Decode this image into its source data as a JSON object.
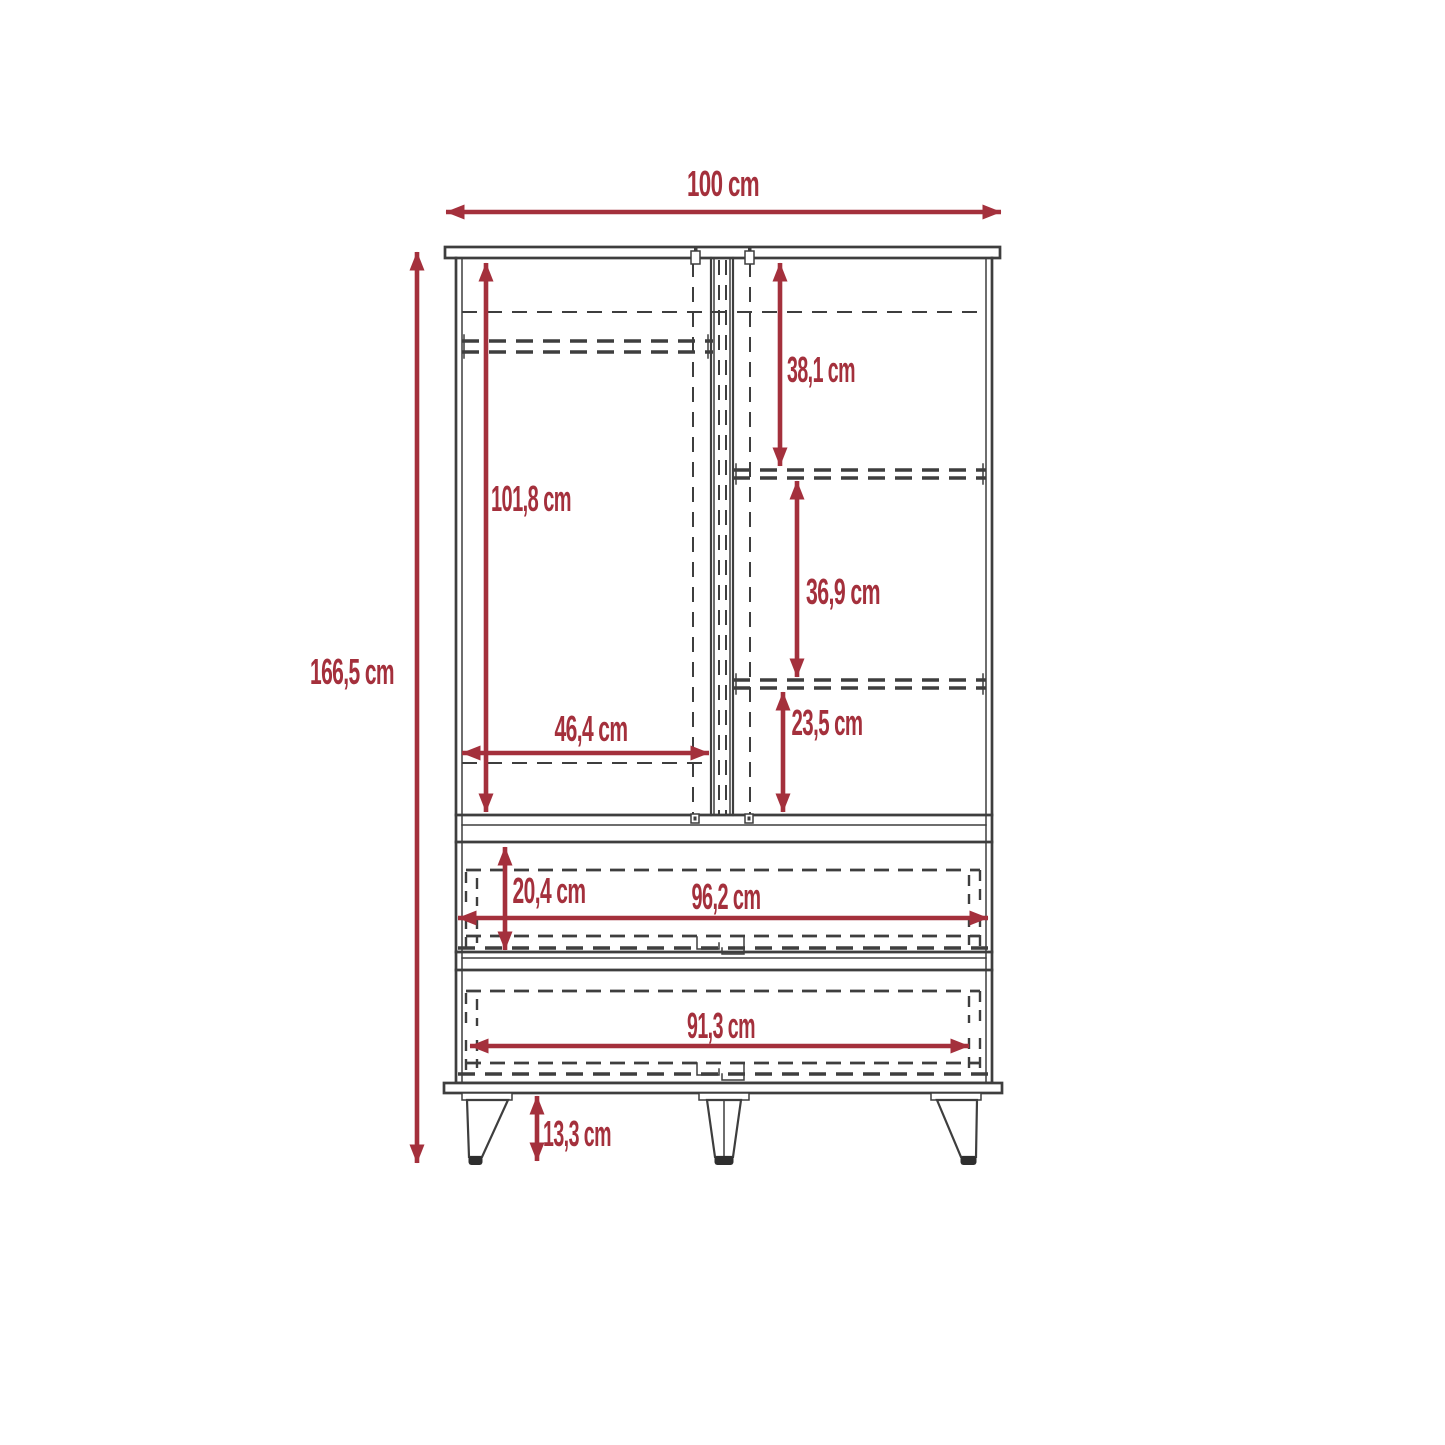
{
  "diagram": {
    "type": "furniture dimension drawing (wardrobe front elevation)",
    "unit": "cm",
    "colors": {
      "accent": "#A4303C",
      "line": "#3E3E3E",
      "background": "#FFFFFF",
      "foot": "#2E2E2E"
    },
    "dimensions": {
      "total_width": {
        "label": "100 cm",
        "value": 100
      },
      "total_height": {
        "label": "166,5 cm",
        "value": 166.5
      },
      "door_interior_height": {
        "label": "101,8 cm",
        "value": 101.8
      },
      "upper_right_shelf_height": {
        "label": "38,1 cm",
        "value": 38.1
      },
      "middle_right_shelf_height": {
        "label": "36,9 cm",
        "value": 36.9
      },
      "lower_right_shelf_height": {
        "label": "23,5 cm",
        "value": 23.5
      },
      "left_compartment_width": {
        "label": "46,4 cm",
        "value": 46.4
      },
      "drawer_height": {
        "label": "20,4 cm",
        "value": 20.4
      },
      "drawer_opening_width": {
        "label": "96,2 cm",
        "value": 96.2
      },
      "lower_drawer_front_width": {
        "label": "91,3 cm",
        "value": 91.3
      },
      "leg_height": {
        "label": "13,3 cm",
        "value": 13.3
      }
    }
  }
}
